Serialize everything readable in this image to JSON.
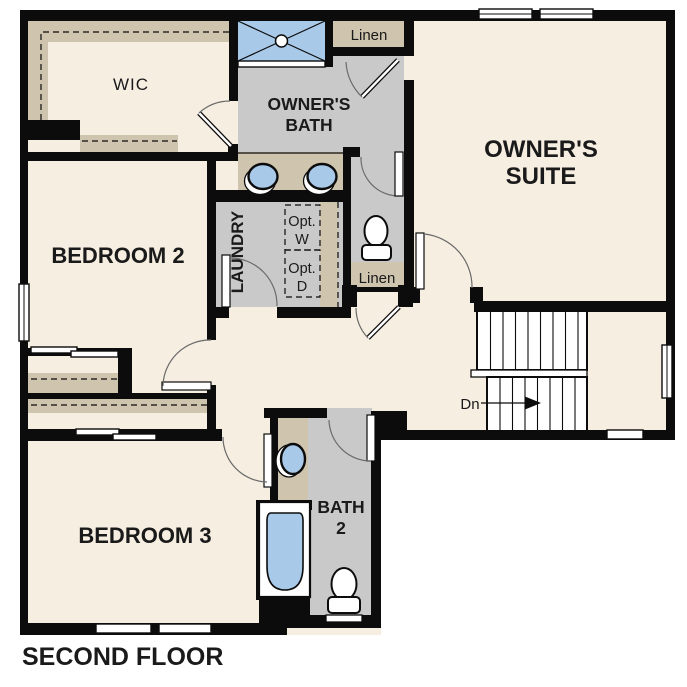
{
  "title": "SECOND FLOOR",
  "colors": {
    "paper": "#ffffff",
    "floor": "#f6eee1",
    "wall": "#0c0c0c",
    "bath_floor": "#c9c9c9",
    "cabinet": "#cfc4ae",
    "fixture_blue": "#a9c9e9",
    "appliance": "#e4e4e4",
    "arc": "#6a6a6a",
    "text": "#1a1a1a"
  },
  "labels": {
    "wic": "WIC",
    "owners_bath_1": "OWNER'S",
    "owners_bath_2": "BATH",
    "linen_top": "Linen",
    "owners_suite_1": "OWNER'S",
    "owners_suite_2": "SUITE",
    "bedroom2": "BEDROOM 2",
    "laundry": "LAUNDRY",
    "opt_washer_1": "Opt.",
    "opt_washer_2": "W",
    "opt_dryer_1": "Opt.",
    "opt_dryer_2": "D",
    "linen_hall": "Linen",
    "stairs_dn": "Dn",
    "bedroom3": "BEDROOM 3",
    "bath2_1": "BATH",
    "bath2_2": "2",
    "floor_title": "SECOND FLOOR"
  },
  "fixtures": {
    "shower": "walk-in-shower",
    "owners_vanity": "double-sink-vanity",
    "owners_toilet": "toilet",
    "hall_bath_vanity": "single-sink-vanity",
    "hall_bath_tub": "bathtub",
    "hall_bath_toilet": "toilet",
    "washer": "optional-washer",
    "dryer": "optional-dryer",
    "stairs": "staircase-down"
  }
}
